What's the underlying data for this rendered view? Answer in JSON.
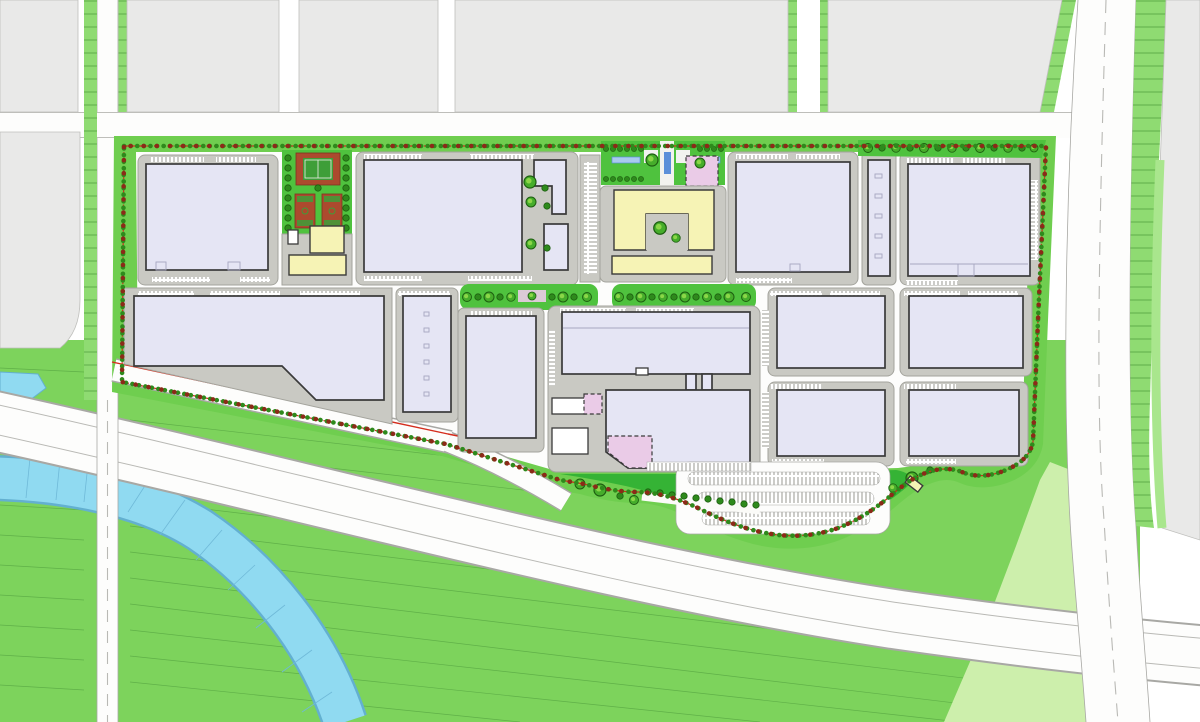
{
  "canvas": {
    "width": 1200,
    "height": 722
  },
  "scene": {
    "kind": "site-master-plan",
    "view": "top-down"
  },
  "colors": {
    "page-bg": "#FFFFFF",
    "context-block": "#E9E9E8",
    "context-stroke": "#BFBFBC",
    "road-fill": "#FDFDFC",
    "road-edge": "#A8A8A4",
    "lane-line": "#B9B9B5",
    "verge-green": "#8FDB72",
    "verge-tick": "#53A03F",
    "field-green": "#7DD35C",
    "field-line": "#55A441",
    "light-green": "#CDEFAC",
    "park-green": "#4FC23E",
    "dark-park-green": "#35B335",
    "site-edge-green": "#6FCE4F",
    "river-fill": "#90DAF1",
    "river-edge": "#63B0D0",
    "river-hatch": "#6FB9D8",
    "pad-fill": "#C9C9C3",
    "pad-stroke": "#A4A49D",
    "building-fill": "#E5E5F4",
    "building-stroke": "#3A3A3A",
    "building-inner": "#A6A6C0",
    "yellow-fill": "#F6F3B5",
    "pink-fill": "#EACBE7",
    "court-red": "#AC4A2E",
    "court-red-stroke": "#7E3420",
    "court-green": "#3E9E38",
    "court-line": "#EDEDE8",
    "tree-dark": "#2E8A1C",
    "tree-mid": "#46AD2B",
    "tree-light": "#8FD84A",
    "tree-stroke": "#1D5E10",
    "boundary-red": "#D42C1C",
    "boundary-tree-red": "#8B2A18",
    "stall-stroke": "#8C8C86",
    "water-blue": "#5B8FD9",
    "water-light": "#A9CBEF",
    "plaza-paving": "#F2F2EF"
  }
}
